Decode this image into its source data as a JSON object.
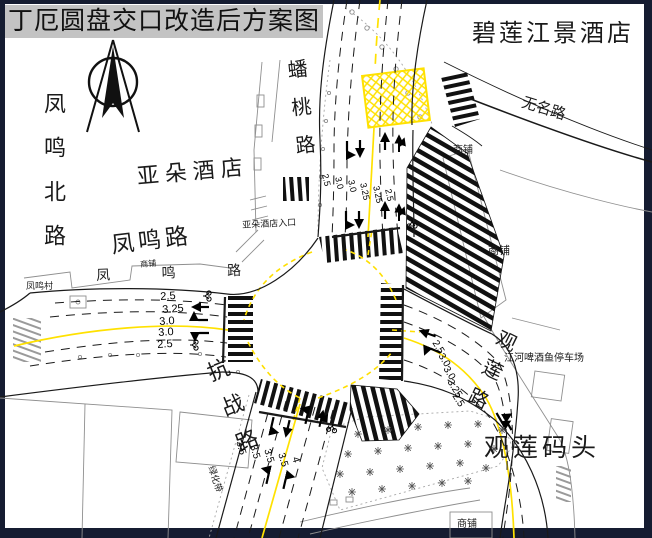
{
  "title": "丁厄圆盘交口改造后方案图",
  "places": {
    "bilian_hotel": "碧莲江景酒店",
    "wuming_road": "无名路",
    "fengming_north_road": "凤鸣北路",
    "yaduo_hotel": "亚朵酒店",
    "fengming_road": "凤鸣路",
    "fengming_road_spaced": "凤 鸣 路",
    "fengming_village": "凤鸣村",
    "pantao_road": "蟠桃路",
    "kangzhan_road": "抗战路",
    "guanlian_road": "观莲路",
    "guanlian_wharf": "观莲码头",
    "parking_lot": "江河啤酒鱼停车场",
    "yaduo_entrance": "亚朵酒店入口",
    "shop_ne": "商铺",
    "shop_e": "商铺",
    "shop_s": "商铺",
    "shop_w": "商铺",
    "greenbelt": "绿化带"
  },
  "lane_widths": {
    "north": [
      "2.5",
      "3.0",
      "3.0",
      "3.25",
      "3.25",
      "2.5"
    ],
    "west": [
      "2.5",
      "3.25",
      "3.0",
      "3.0",
      "2.5"
    ],
    "south": [
      "3.5",
      "3.5",
      "3.5",
      "3.5",
      "4"
    ],
    "east": [
      "2.5",
      "3.0",
      "3.0",
      "3.25",
      "2.5"
    ]
  },
  "colors": {
    "border": "#151c31",
    "paper": "#ffffff",
    "titlebar_bg": "#c3c3c3",
    "line_black": "#1a1a1a",
    "line_gray": "#909090",
    "marking_yellow": "#ffe100"
  }
}
